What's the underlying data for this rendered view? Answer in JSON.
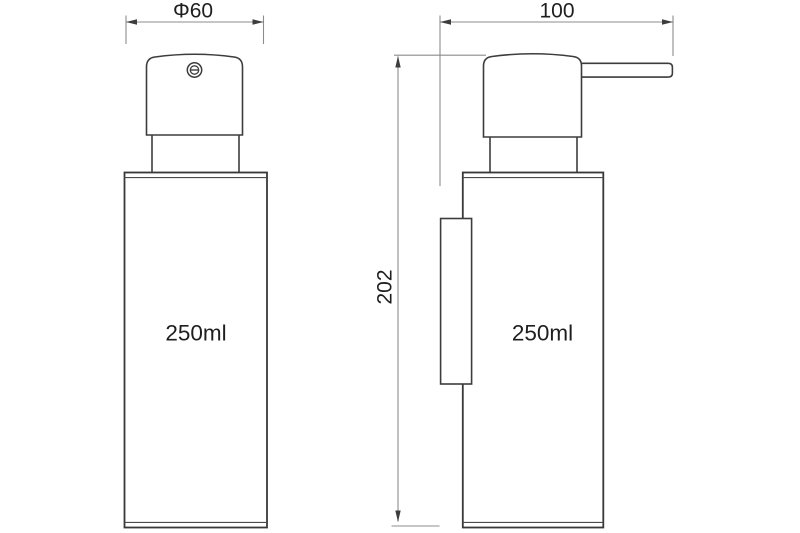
{
  "drawing": {
    "type": "technical-dimension-drawing",
    "subject": "soap dispenser, two orthographic views",
    "background_color": "#ffffff",
    "line_color": "#3d3d3d",
    "dimension_line_color": "#8c8c8c",
    "text_color": "#1e1e1e",
    "front_view": {
      "diameter_dimension": "Φ60",
      "capacity": "250ml"
    },
    "side_view": {
      "depth_dimension": "100",
      "height_dimension": "202",
      "capacity": "250ml"
    }
  }
}
